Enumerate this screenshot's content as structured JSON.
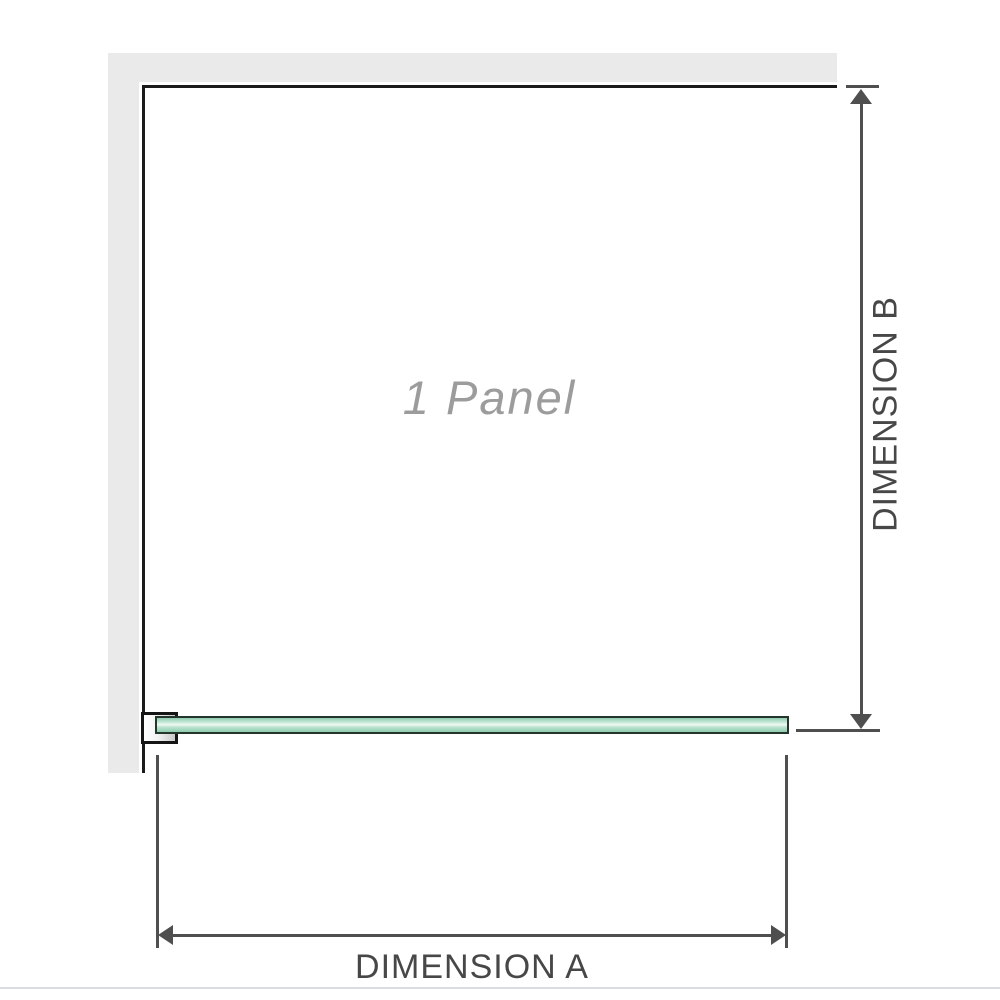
{
  "labels": {
    "panel": "1 Panel",
    "dimension_a": "DIMENSION A",
    "dimension_b": "DIMENSION B"
  },
  "colors": {
    "background": "#ffffff",
    "wall": "#eaeaea",
    "panel_border": "#1b1b1b",
    "dimension": "#4f4f4f",
    "dimension_text": "#474747",
    "panel_label": "#9c9c9c",
    "glass_border": "#24352c",
    "glass_green": "#8fccaf",
    "glass_green_light": "#eef9f4",
    "bracket_border": "#151515",
    "baseline": "#d9dde1"
  }
}
